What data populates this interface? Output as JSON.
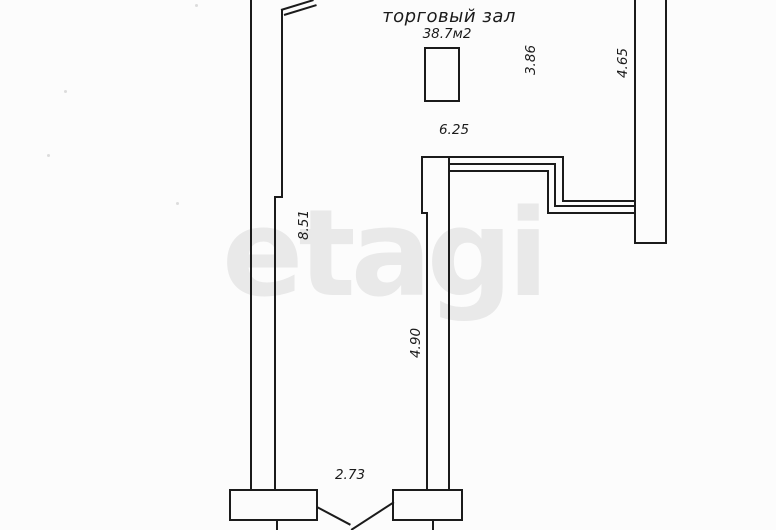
{
  "plan": {
    "title": "торговый зал",
    "area": "38.7м2",
    "watermark": "etagi"
  },
  "dimensions": {
    "width_top": "6.25",
    "height_inner_right": "3.86",
    "height_right_wall": "4.65",
    "height_left_wall": "8.51",
    "height_middle_wall": "4.90",
    "width_bottom": "2.73"
  },
  "colors": {
    "line": "#1b1b1b",
    "background": "#fcfcfc",
    "watermark": "#e9e9e9"
  }
}
